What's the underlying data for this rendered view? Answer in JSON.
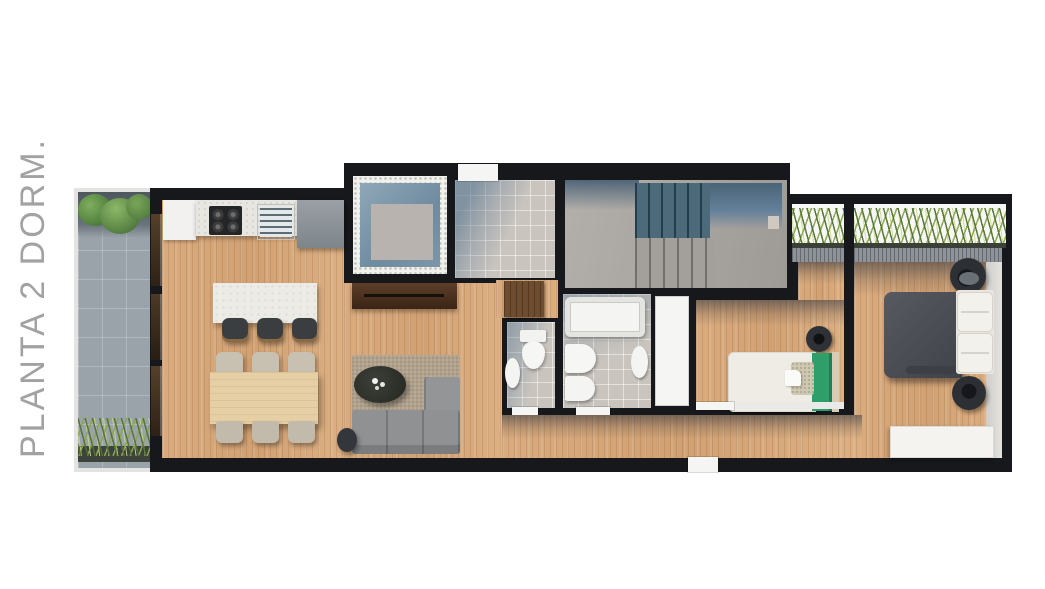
{
  "label": {
    "text": "PLANTA 2 DORM."
  },
  "floorplan": {
    "kind": "apartment-top-view-render",
    "rooms": [
      "terrace",
      "kitchen",
      "dining-area",
      "living-room",
      "internal-patio",
      "entry-hall",
      "staircase",
      "bathroom-small",
      "bathroom-main",
      "closet",
      "hallway",
      "bedroom-single",
      "bedroom-master",
      "roof-planter"
    ],
    "furniture": [
      "refrigerator",
      "kitchen-counter",
      "stove",
      "kitchen-sink",
      "tall-cabinet",
      "kitchen-island",
      "bar-stool",
      "dining-table",
      "dining-chair",
      "tv-console",
      "rug",
      "coffee-table",
      "sofa",
      "side-table",
      "hall-cabinet",
      "bathtub",
      "toilet",
      "bidet",
      "washbasin",
      "wardrobe",
      "single-bed",
      "double-bed",
      "nightstand",
      "dresser",
      "planter-grasses",
      "garden-bushes",
      "sliding-glass-doors"
    ],
    "colors": {
      "background": "#ffffff",
      "walls": "#17181b",
      "wood_floor": "#d7a97c",
      "terrace_tile": "#9aa2aa",
      "concrete": "#a8a49f",
      "stair_steps_blue": "#3f5a69",
      "bathroom_tile": "#c9c4be",
      "bed_green_accent": "#2e9e6b",
      "duvet_gray": "#484c53",
      "plant_green": "#5d8a45",
      "label_gray": "#a2a2a2"
    }
  }
}
